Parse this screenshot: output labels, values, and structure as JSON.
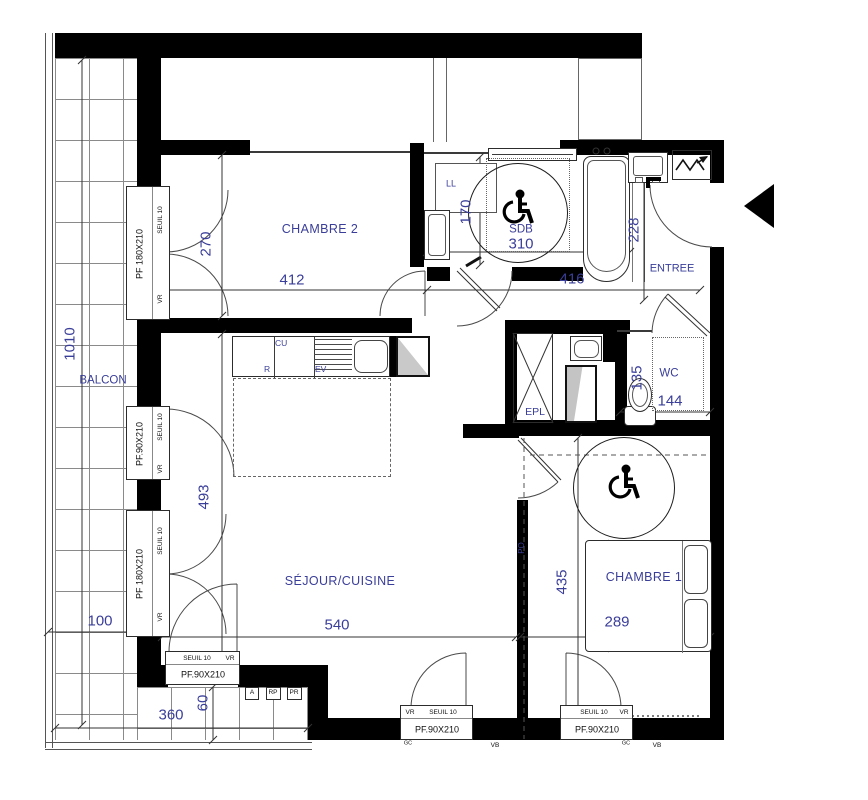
{
  "labels": {
    "chambre2": "CHAMBRE 2",
    "sejour": "SÉJOUR/CUISINE",
    "chambre1": "CHAMBRE 1",
    "balcon": "BALCON",
    "entree": "ENTREE",
    "wc": "WC",
    "sdb": "SDB",
    "epl": "EPL",
    "po": "PO",
    "ll": "LL",
    "cu": "CU",
    "r": "R",
    "ev": "EV",
    "a": "A",
    "rp": "RP",
    "pr": "PR",
    "vb": "VB",
    "gc": "GC",
    "seuil": "SEUIL 10",
    "vr": "VR",
    "pf180": "PF 180X210",
    "pf90": "PF.90X210"
  },
  "dims": {
    "chambre2_w": "412",
    "chambre2_h": "270",
    "sdb_w": "310",
    "sdb_h": "170",
    "hall_w": "416",
    "entree_h": "228",
    "balcon_h": "1010",
    "balcon_w": "100",
    "sejour_w": "540",
    "sejour_h": "493",
    "chambre1_w": "289",
    "chambre1_h": "435",
    "wc_w": "144",
    "wc_h": "135",
    "terrasse_w": "360",
    "step_h": "60"
  },
  "colors": {
    "dim_text": "#3a3e99",
    "wall": "#000000"
  }
}
